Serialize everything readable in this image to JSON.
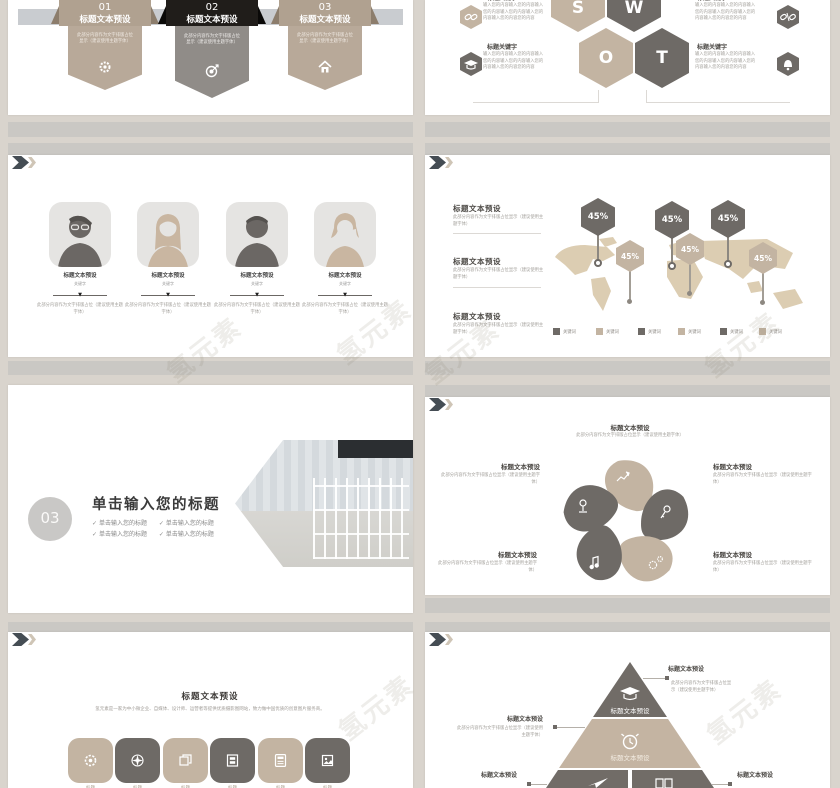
{
  "watermark": {
    "text": "氢元素"
  },
  "palette": {
    "page_bg": "#d9d4cd",
    "letterbox_band": "#cac8c4",
    "slide_bg": "#ffffff",
    "tan": "#c3b4a2",
    "dark_gray": "#6e6a66",
    "near_black": "#201d1a",
    "header_bar": "#c9ccd0",
    "chevron_dark": "#454d54",
    "chevron_light": "#cfc5b6"
  },
  "agenda_slide": {
    "items": [
      {
        "num": "01",
        "title": "标题文本预设",
        "body": "此部分内容作为文字排版占位显示（建议使用主题字体）",
        "icon": "gear-icon"
      },
      {
        "num": "02",
        "title": "标题文本预设",
        "body": "此部分内容作为文字排版占位显示（建议使用主题字体）",
        "icon": "target-icon"
      },
      {
        "num": "03",
        "title": "标题文本预设",
        "body": "此部分内容作为文字排版占位显示（建议使用主题字体）",
        "icon": "home-icon"
      }
    ]
  },
  "swot_slide": {
    "letters": {
      "s": "S",
      "w": "W",
      "o": "O",
      "t": "T"
    },
    "blocks": [
      {
        "heading": "标题关键字",
        "body": "输入您的内容输入您的内容输入您的内容输入您的内容输入您的内容输入您的内容您的内容",
        "icon": "link-icon"
      },
      {
        "heading": "标题关键字",
        "body": "输入您的内容输入您的内容输入您的内容输入您的内容输入您的内容输入您的内容您的内容",
        "icon": "graduation-cap-icon"
      },
      {
        "heading": "标题关键字",
        "body": "输入您的内容输入您的内容输入您的内容输入您的内容输入您的内容输入您的内容您的内容",
        "icon": "broken-link-icon"
      },
      {
        "heading": "标题关键字",
        "body": "输入您的内容输入您的内容输入您的内容输入您的内容输入您的内容输入您的内容您的内容",
        "icon": "bell-icon"
      }
    ]
  },
  "team_slide": {
    "members": [
      {
        "title": "标题文本预设",
        "sub": "关键字",
        "body": "此部分内容作为文字排版占位（建议使用主题字体）",
        "avatar": "male-glasses"
      },
      {
        "title": "标题文本预设",
        "sub": "关键字",
        "body": "此部分内容作为文字排版占位（建议使用主题字体）",
        "avatar": "female-long-hair"
      },
      {
        "title": "标题文本预设",
        "sub": "关键字",
        "body": "此部分内容作为文字排版占位（建议使用主题字体）",
        "avatar": "male"
      },
      {
        "title": "标题文本预设",
        "sub": "关键字",
        "body": "此部分内容作为文字排版占位（建议使用主题字体）",
        "avatar": "female-short-hair"
      }
    ]
  },
  "map_slide": {
    "blocks": [
      {
        "heading": "标题文本预设",
        "body": "此部分内容作为文字排版占位显示（建议使用主题字体）"
      },
      {
        "heading": "标题文本预设",
        "body": "此部分内容作为文字排版占位显示（建议使用主题字体）"
      },
      {
        "heading": "标题文本预设",
        "body": "此部分内容作为文字排版占位显示（建议使用主题字体）"
      }
    ],
    "markers": [
      {
        "value": "45%"
      },
      {
        "value": "45%"
      },
      {
        "value": "45%"
      },
      {
        "value": "45%"
      },
      {
        "value": "45%"
      },
      {
        "value": "45%"
      }
    ],
    "legend": [
      {
        "label": "关键词"
      },
      {
        "label": "关键词"
      },
      {
        "label": "关键词"
      },
      {
        "label": "关键词"
      },
      {
        "label": "关键词"
      },
      {
        "label": "关键词"
      }
    ]
  },
  "cover_slide": {
    "number": "03",
    "title": "单击输入您的标题",
    "check": "✓",
    "bullets": [
      "单击输入您的标题",
      "单击输入您的标题",
      "单击输入您的标题",
      "单击输入您的标题"
    ]
  },
  "cycle_slide": {
    "blocks": [
      {
        "heading": "标题文本预设",
        "body": "此部分内容作为文字排版占位显示（建议使用主题字体）",
        "icon": "growth-chart-icon"
      },
      {
        "heading": "标题文本预设",
        "body": "此部分内容作为文字排版占位显示（建议使用主题字体）",
        "icon": "key-icon"
      },
      {
        "heading": "标题文本预设",
        "body": "此部分内容作为文字排版占位显示（建议使用主题字体）",
        "icon": "gears-icon"
      },
      {
        "heading": "标题文本预设",
        "body": "此部分内容作为文字排版占位显示（建议使用主题字体）",
        "icon": "music-note-icon"
      },
      {
        "heading": "标题文本预设",
        "body": "此部分内容作为文字排版占位显示（建议使用主题字体）",
        "icon": "location-pin-icon"
      }
    ]
  },
  "services_slide": {
    "heading": "标题文本预设",
    "body": "氢元素是一家为中小微企业、自媒体、设计师、运营者等提供优质摄影图网站，致力做中国优质的创意图片服务商。",
    "tiles": [
      {
        "label": "标题",
        "icon": "gear-icon"
      },
      {
        "label": "标题",
        "icon": "compass-icon"
      },
      {
        "label": "标题",
        "icon": "copy-icon"
      },
      {
        "label": "标题",
        "icon": "window-icon"
      },
      {
        "label": "标题",
        "icon": "calculator-icon"
      },
      {
        "label": "标题",
        "icon": "photo-icon"
      }
    ]
  },
  "pyramid_slide": {
    "top_label": "标题文本预设",
    "middle_label": "标题文本预设",
    "callouts": [
      {
        "heading": "标题文本预设",
        "body": "此部分内容作为文字排版占位显示（建议使用主题字体）"
      },
      {
        "heading": "标题文本预设",
        "body": "此部分内容作为文字排版占位显示（建议使用主题字体）"
      },
      {
        "heading": "标题文本预设"
      },
      {
        "heading": "标题文本预设"
      }
    ]
  }
}
